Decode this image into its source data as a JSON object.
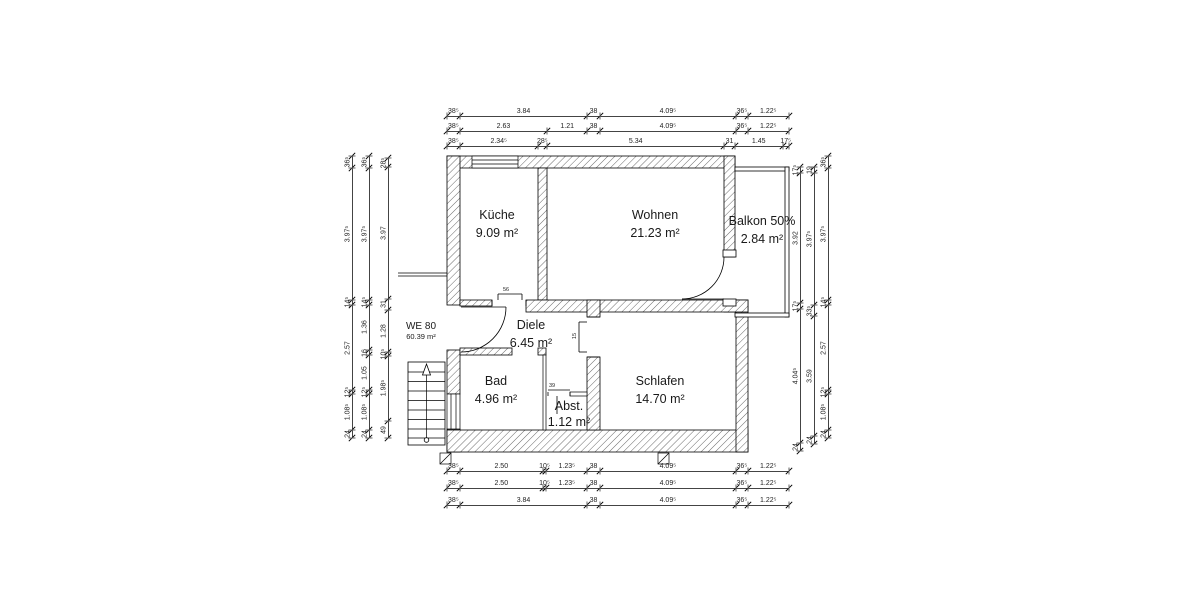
{
  "unit": {
    "name": "WE 80",
    "area": "60.39 m²"
  },
  "rooms": {
    "kueche": {
      "name": "Küche",
      "area": "9.09 m²"
    },
    "wohnen": {
      "name": "Wohnen",
      "area": "21.23 m²"
    },
    "balkon": {
      "name": "Balkon 50%",
      "area": "2.84 m²"
    },
    "diele": {
      "name": "Diele",
      "area": "6.45 m²"
    },
    "bad": {
      "name": "Bad",
      "area": "4.96 m²"
    },
    "abst": {
      "name": "Abst.",
      "area": "1.12 m²"
    },
    "schlafen": {
      "name": "Schlafen",
      "area": "14.70 m²"
    }
  },
  "micro_dims": {
    "kueche_door": "56",
    "schlafen_door": "15",
    "abst_door": "39"
  },
  "dimensions": {
    "top1": [
      {
        "t": "38⁵",
        "m": 0.385
      },
      {
        "t": "3.84",
        "m": 3.84
      },
      {
        "t": "38",
        "m": 0.38
      },
      {
        "t": "4.09⁵",
        "m": 4.095
      },
      {
        "t": "36⁵",
        "m": 0.365
      },
      {
        "t": "1.22⁵",
        "m": 1.225
      }
    ],
    "top2": [
      {
        "t": "38⁵",
        "m": 0.385
      },
      {
        "t": "2.63",
        "m": 2.63
      },
      {
        "t": "1.21",
        "m": 1.21
      },
      {
        "t": "38",
        "m": 0.38
      },
      {
        "t": "4.09⁵",
        "m": 4.095
      },
      {
        "t": "36⁵",
        "m": 0.365
      },
      {
        "t": "1.22⁵",
        "m": 1.225
      }
    ],
    "top3": [
      {
        "t": "38⁵",
        "m": 0.385
      },
      {
        "t": "2.34⁵",
        "m": 2.345
      },
      {
        "t": "28⁵",
        "m": 0.285
      },
      {
        "t": "5.34",
        "m": 5.34
      },
      {
        "t": "31",
        "m": 0.31
      },
      {
        "t": "1.45",
        "m": 1.45
      },
      {
        "t": "17⁵",
        "m": 0.175
      }
    ],
    "bottom1": [
      {
        "t": "38⁵",
        "m": 0.385
      },
      {
        "t": "2.50",
        "m": 2.5
      },
      {
        "t": "10⁵",
        "m": 0.105
      },
      {
        "t": "1.23⁵",
        "m": 1.235
      },
      {
        "t": "38",
        "m": 0.38
      },
      {
        "t": "4.09⁵",
        "m": 4.095
      },
      {
        "t": "36⁵",
        "m": 0.365
      },
      {
        "t": "1.22⁵",
        "m": 1.225
      }
    ],
    "bottom2": [
      {
        "t": "38⁵",
        "m": 0.385
      },
      {
        "t": "2.50",
        "m": 2.5
      },
      {
        "t": "10⁵",
        "m": 0.105
      },
      {
        "t": "1.23⁵",
        "m": 1.235
      },
      {
        "t": "38",
        "m": 0.38
      },
      {
        "t": "4.09⁵",
        "m": 4.095
      },
      {
        "t": "36⁵",
        "m": 0.365
      },
      {
        "t": "1.22⁵",
        "m": 1.225
      }
    ],
    "bottom3": [
      {
        "t": "38⁵",
        "m": 0.385
      },
      {
        "t": "3.84",
        "m": 3.84
      },
      {
        "t": "38",
        "m": 0.38
      },
      {
        "t": "4.09⁵",
        "m": 4.095
      },
      {
        "t": "36⁵",
        "m": 0.365
      },
      {
        "t": "1.22⁵",
        "m": 1.225
      }
    ],
    "left1": [
      {
        "t": "36⁵",
        "m": 0.365
      },
      {
        "t": "3.97⁵",
        "m": 3.975
      },
      {
        "t": "14⁵",
        "m": 0.145
      },
      {
        "t": "2.57",
        "m": 2.57
      },
      {
        "t": "12⁵",
        "m": 0.125
      },
      {
        "t": "1.08⁵",
        "m": 1.085
      },
      {
        "t": "24",
        "m": 0.24
      }
    ],
    "left2": [
      {
        "t": "36⁵",
        "m": 0.365
      },
      {
        "t": "3.97⁵",
        "m": 3.975
      },
      {
        "t": "14⁵",
        "m": 0.145
      },
      {
        "t": "1.36",
        "m": 1.36
      },
      {
        "t": "16",
        "m": 0.16
      },
      {
        "t": "1.05",
        "m": 1.05
      },
      {
        "t": "12⁵",
        "m": 0.125
      },
      {
        "t": "1.08⁵",
        "m": 1.085
      },
      {
        "t": "24",
        "m": 0.24
      }
    ],
    "left3": [
      {
        "t": "28⁵",
        "m": 0.285
      },
      {
        "t": "3.97",
        "m": 3.97
      },
      {
        "t": "31",
        "m": 0.31
      },
      {
        "t": "1.28",
        "m": 1.28
      },
      {
        "t": "10⁵",
        "m": 0.105
      },
      {
        "t": "1.98⁵",
        "m": 1.985
      },
      {
        "t": "49",
        "m": 0.49
      }
    ],
    "right1": [
      {
        "t": "17⁵",
        "m": 0.175
      },
      {
        "t": "3.92",
        "m": 3.92
      },
      {
        "t": "17⁵",
        "m": 0.175
      },
      {
        "t": "4.04⁵",
        "m": 4.045
      },
      {
        "t": "24",
        "m": 0.24
      }
    ],
    "right2": [
      {
        "t": "19",
        "m": 0.19
      },
      {
        "t": "3.97⁵",
        "m": 3.975
      },
      {
        "t": "33⁵",
        "m": 0.335
      },
      {
        "t": "3.59",
        "m": 3.59
      },
      {
        "t": "24",
        "m": 0.24
      }
    ],
    "right3": [
      {
        "t": "36⁵",
        "m": 0.365
      },
      {
        "t": "3.97⁵",
        "m": 3.975
      },
      {
        "t": "14⁵",
        "m": 0.145
      },
      {
        "t": "2.57",
        "m": 2.57
      },
      {
        "t": "12⁵",
        "m": 0.125
      },
      {
        "t": "1.08⁵",
        "m": 1.085
      },
      {
        "t": "24",
        "m": 0.24
      }
    ]
  }
}
